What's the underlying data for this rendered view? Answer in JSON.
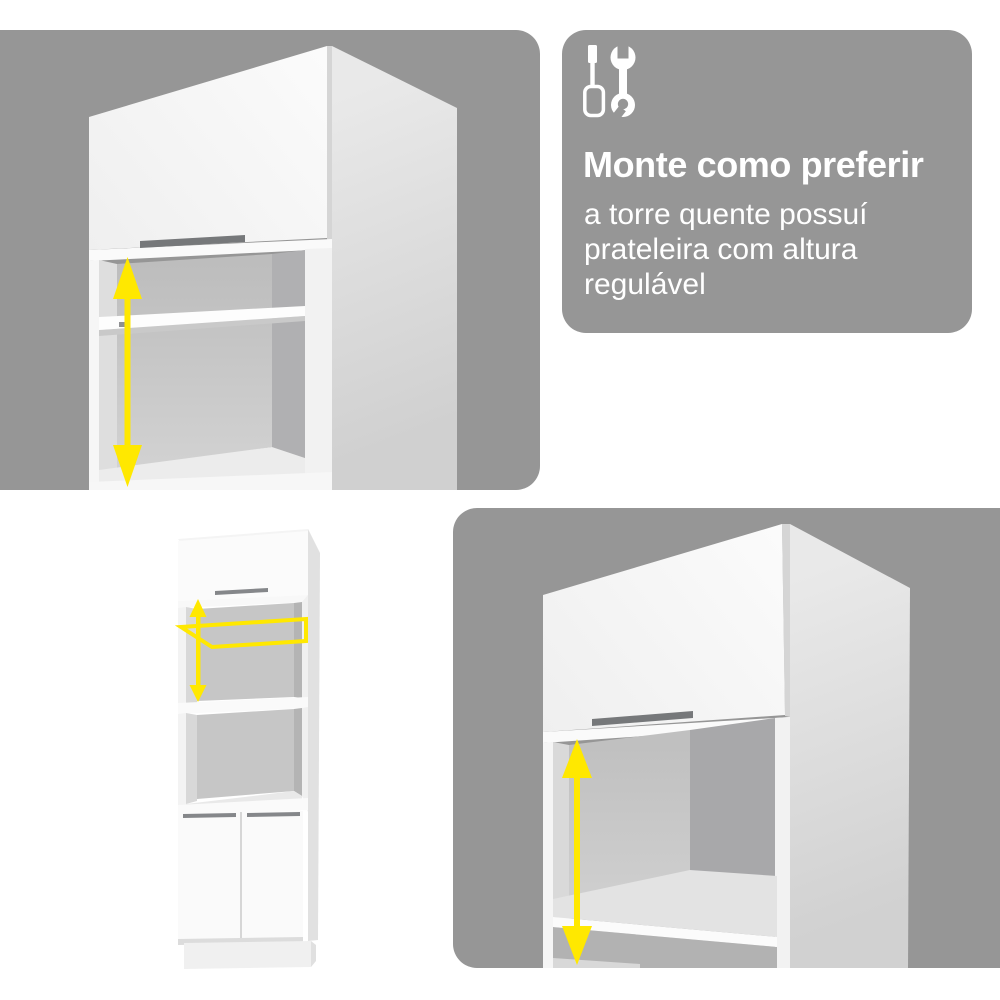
{
  "colors": {
    "panel_gray": "#969696",
    "accent_yellow": "#ffe800",
    "cabinet_white": "#fafafa"
  },
  "info_card": {
    "title": "Monte como preferir",
    "body": "a torre quente possuí prateleira com altura regulável",
    "icons": [
      "screwdriver-icon",
      "wrench-icon"
    ]
  },
  "figures": {
    "top_left": {
      "content": "upper cabinet module with flap door, open niche and shelf",
      "annotation": "vertical double-headed arrow showing adjustable shelf height"
    },
    "bottom_left": {
      "content": "full oven tower cabinet with flap door, two niches and double doors",
      "annotations": [
        "yellow outline highlighting removable shelf",
        "vertical double-headed arrow showing adjustable shelf height"
      ]
    },
    "bottom_right": {
      "content": "close-up of cabinet niche with shelf near bottom",
      "annotation": "vertical double-headed arrow showing adjustable shelf height"
    }
  }
}
